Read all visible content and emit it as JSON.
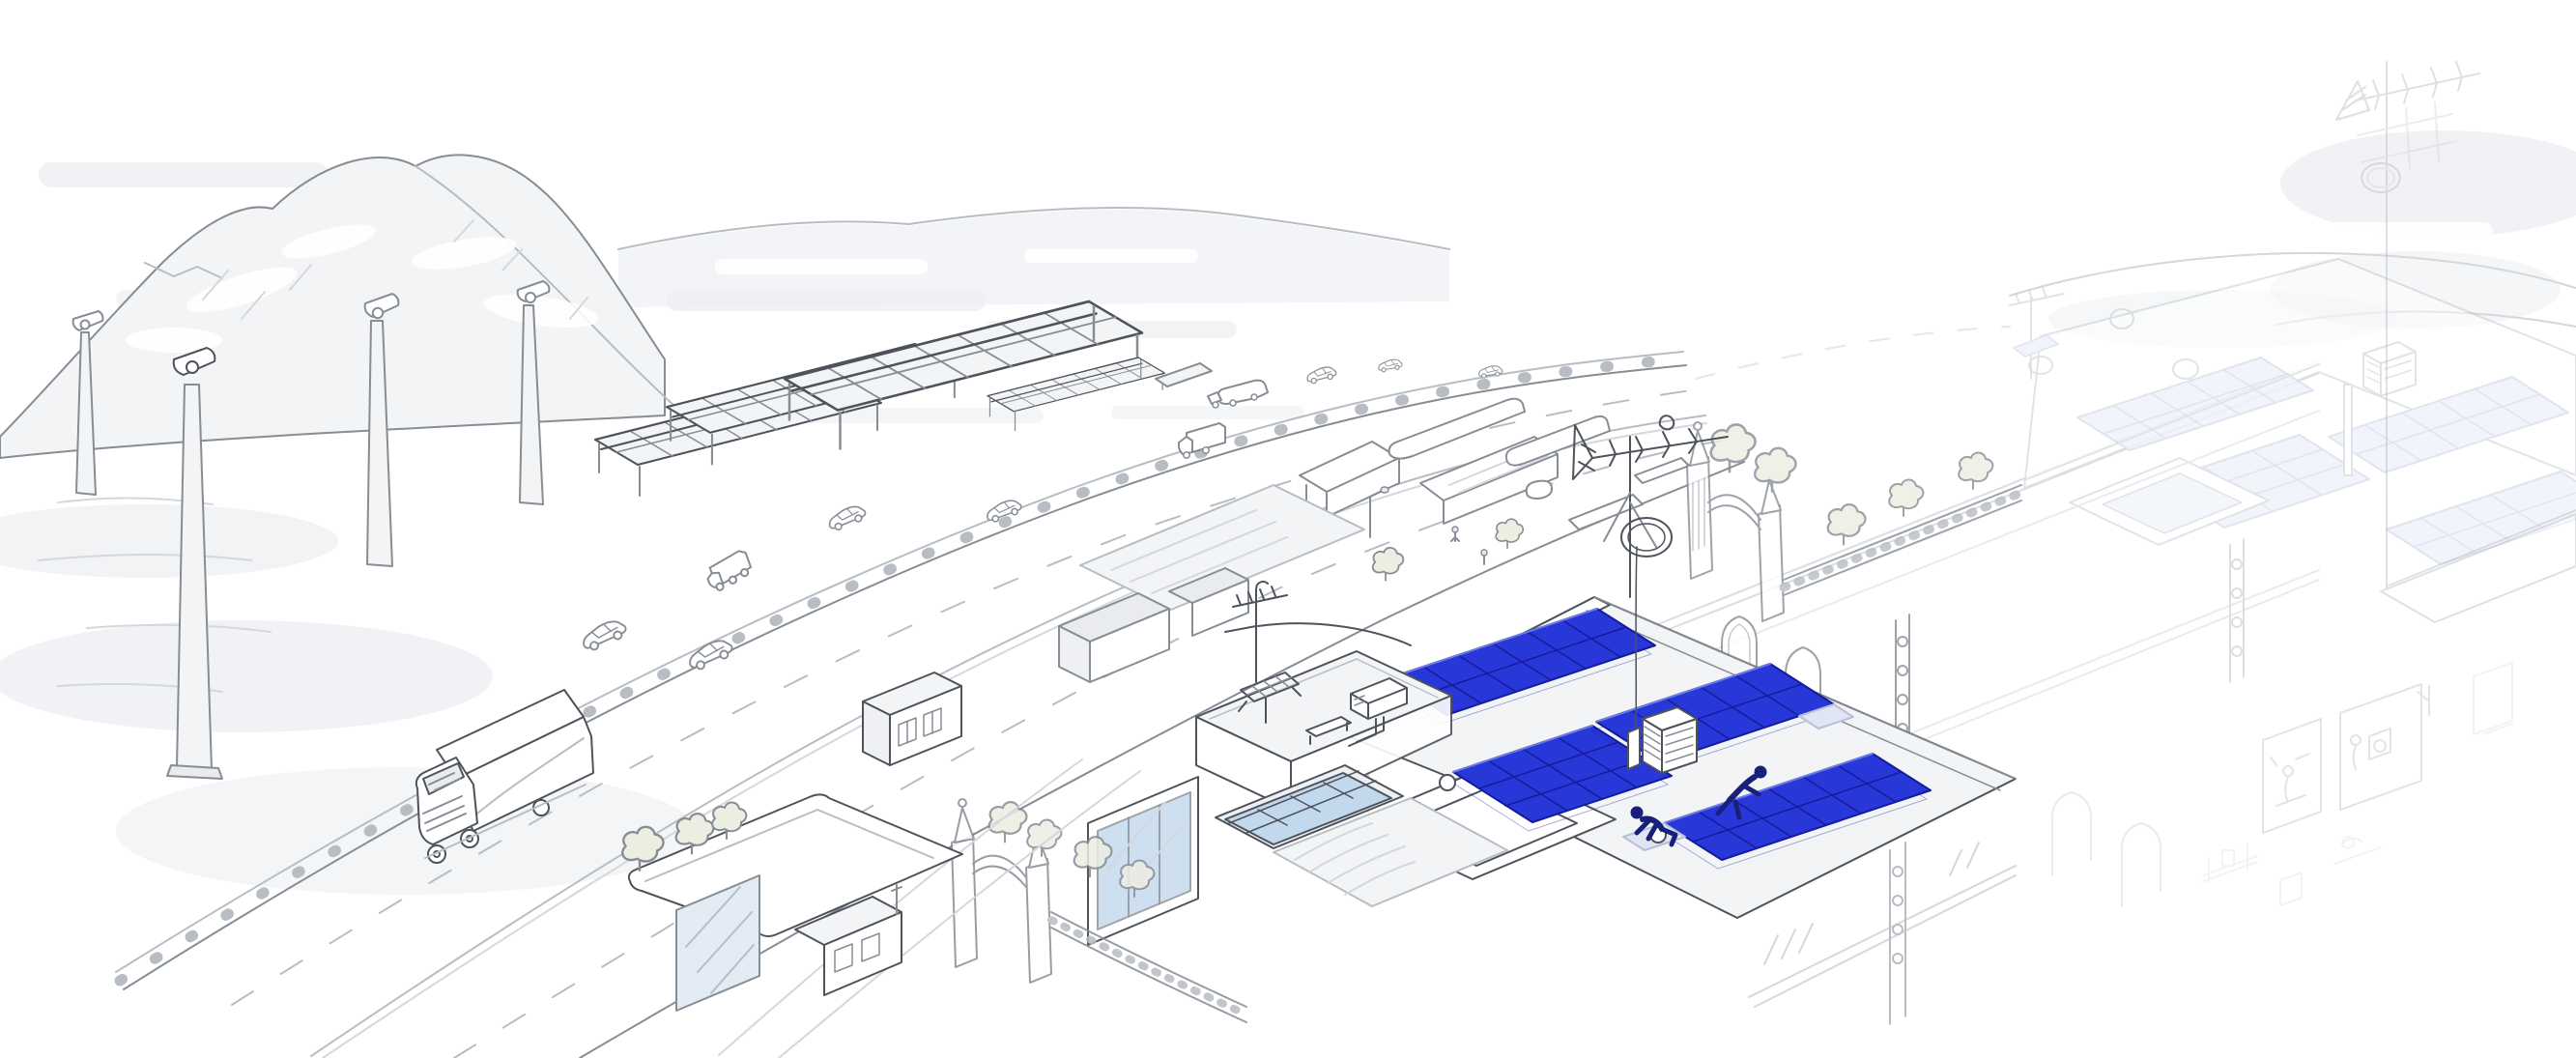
{
  "scene": {
    "description": "Hand-drawn isometric cityscape: wind turbines and mountains on the left, solar canopies and a highway with traffic in the middle distance, and a foreground rooftop where two installers fit royal-blue solar panels; ornate neighbouring buildings with a finished pale solar roof and TV antennas fade to white on the right.",
    "counts": {
      "wind_turbines": 4,
      "solar_canopies": 4,
      "blue_solar_arrays": 4,
      "solar_installers": 2,
      "vehicles": 11
    }
  },
  "colors": {
    "panel_blue": "#2838d8",
    "panel_blue_deep": "#141c9c",
    "panel_blue_light": "#6b79ea",
    "panel_pale": "#dfe5f3",
    "panel_pale_line": "#b7c0d6",
    "worker_navy": "#192079",
    "ink": "#4e535b",
    "line_mid": "#878d95",
    "line_light": "#b8bdc4",
    "line_faint": "#d4d7db",
    "wash_gray": "#e6e8ec",
    "glass_blue": "#c2d8ec",
    "glass_pale": "#e3ecf5",
    "foliage_pale": "#eceee2",
    "paper_white": "#ffffff"
  }
}
